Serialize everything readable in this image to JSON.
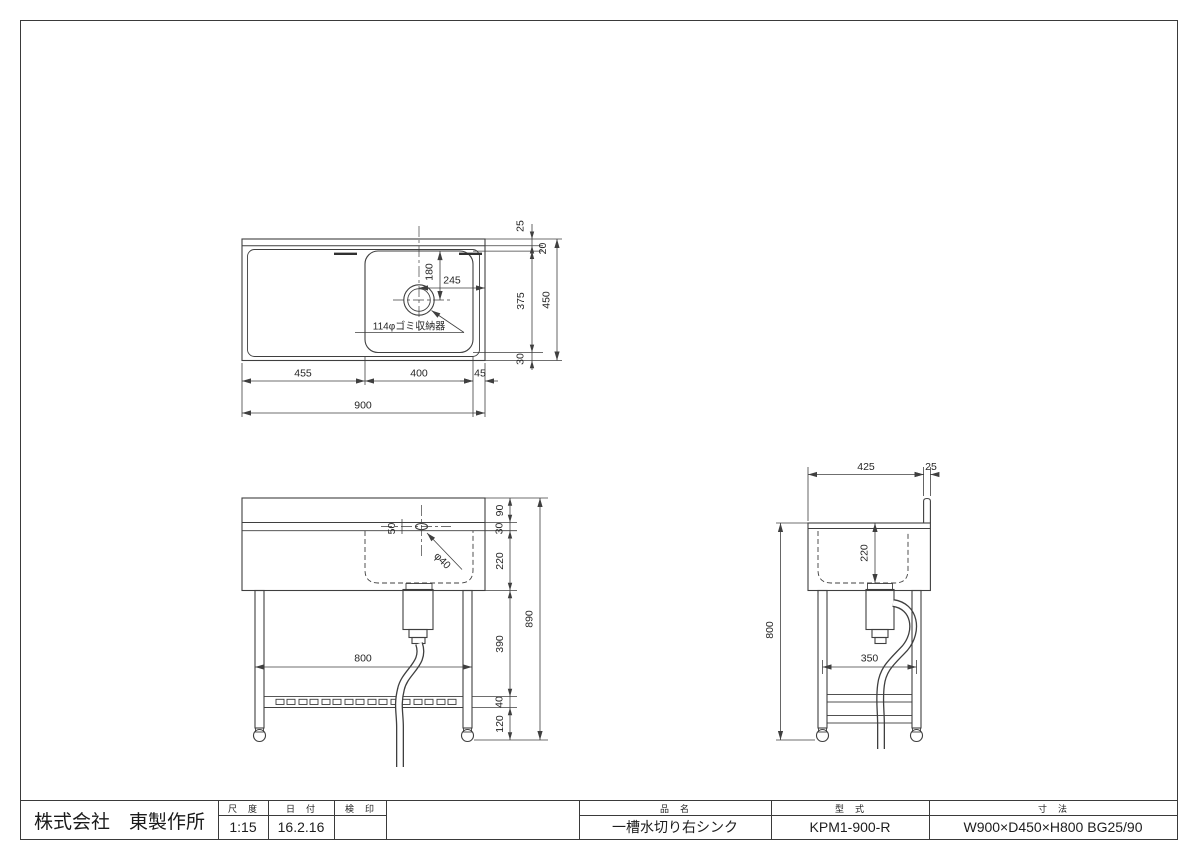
{
  "title_block": {
    "company": "株式会社　東製作所",
    "scale_label": "尺　度",
    "scale_value": "1:15",
    "date_label": "日　付",
    "date_value": "16.2.16",
    "stamp_label": "検　印",
    "stamp_value": "",
    "name_label": "品　名",
    "name_value": "一槽水切り右シンク",
    "model_label": "型　式",
    "model_value": "KPM1-900-R",
    "size_label": "寸　法",
    "size_value": "W900×D450×H800 BG25/90"
  },
  "plan": {
    "drain_note": "114φゴミ収納器",
    "dims": {
      "w_total": "900",
      "w_left": "455",
      "w_bowl": "400",
      "w_right": "45",
      "d_total": "450",
      "d_bg": "25",
      "d_gap": "20",
      "d_bowl": "375",
      "d_front": "30",
      "drain_from_right": "245",
      "drain_from_top": "180"
    }
  },
  "front": {
    "dims": {
      "h_backguard": "90",
      "h_edge": "30",
      "h_bowl": "220",
      "h_mid": "390",
      "h_shelf": "40",
      "h_foot": "120",
      "h_total": "890",
      "w_legs": "800",
      "faucet_offset": "50",
      "faucet_hole": "φ40"
    }
  },
  "side": {
    "dims": {
      "d_counter": "425",
      "d_backguard": "25",
      "h_counter": "800",
      "h_bowl": "220",
      "w_legs": "350"
    }
  }
}
